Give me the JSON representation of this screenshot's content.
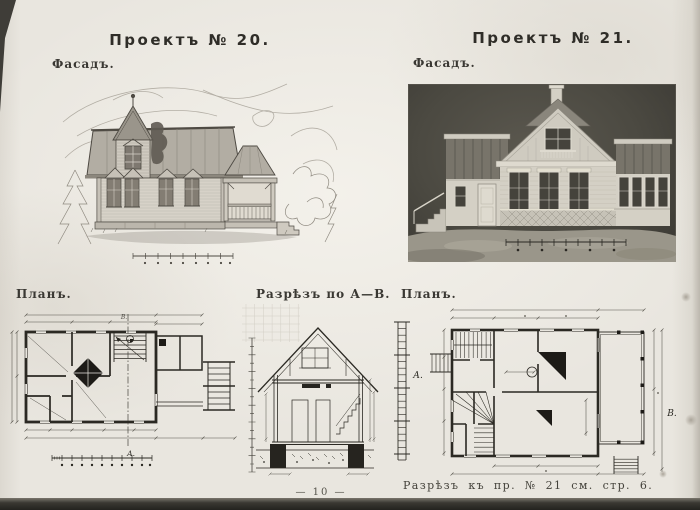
{
  "page": {
    "number": "— 10 —",
    "paper_color": "#e8e5de",
    "ink_color": "#35332e",
    "edge_color": "#2b2a26"
  },
  "project_20": {
    "title": "Проектъ № 20.",
    "facade_label": "Фасадъ.",
    "plan_label": "Планъ."
  },
  "project_21": {
    "title": "Проектъ № 21.",
    "facade_label": "Фасадъ.",
    "plan_label": "Планъ.",
    "caption": "Разрѣзъ къ пр. № 21 см. стр. 6."
  },
  "section": {
    "label": "Разрѣзъ по А—В."
  },
  "markers": {
    "a": "А.",
    "b": "В."
  }
}
